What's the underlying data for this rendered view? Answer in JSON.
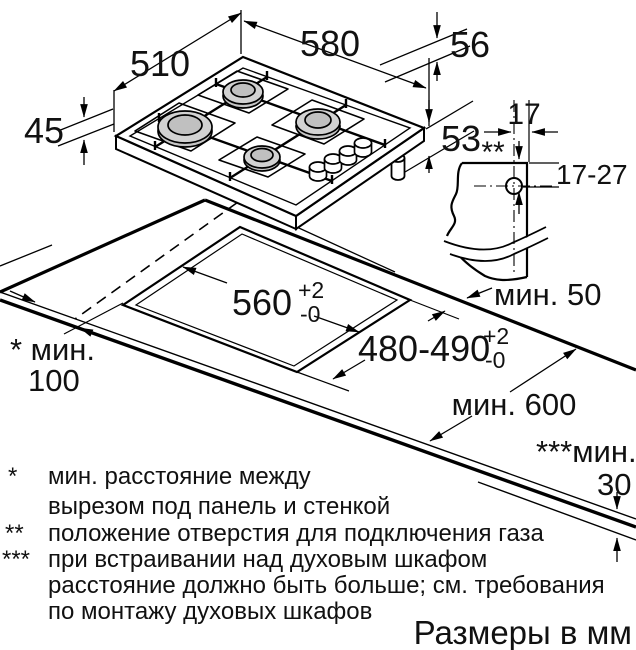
{
  "title": "Размеры в мм",
  "dims": {
    "depth": "510",
    "width": "580",
    "height_above": "45",
    "body_depth_upper": "56",
    "body_depth_lower": "53",
    "conn_offset": "17",
    "conn_marker": "**",
    "conn_range": "17-27",
    "cutout_width": "560",
    "cutout_width_tol_sup": "+2",
    "cutout_width_tol_sub": "-0",
    "cutout_depth": "480-490",
    "cutout_depth_tol_sup": "+2",
    "cutout_depth_tol_sub": "-0",
    "rear_clearance": "мин. 50",
    "side_clearance_label": "* мин.",
    "side_clearance_value": "100",
    "worktop_depth": "мин. 600",
    "oven_clearance_label": "***мин.",
    "oven_clearance_value": "30"
  },
  "footnotes": [
    {
      "marker": "*",
      "lines": [
        "мин. расстояние между",
        "вырезом под панель и стенкой"
      ]
    },
    {
      "marker": "**",
      "lines": [
        "положение отверстия для подключения газа"
      ]
    },
    {
      "marker": "***",
      "lines": [
        "при встраивании над духовым шкафом",
        "расстояние должно быть больше; см. требования",
        "по монтажу духовых шкафов"
      ]
    }
  ]
}
